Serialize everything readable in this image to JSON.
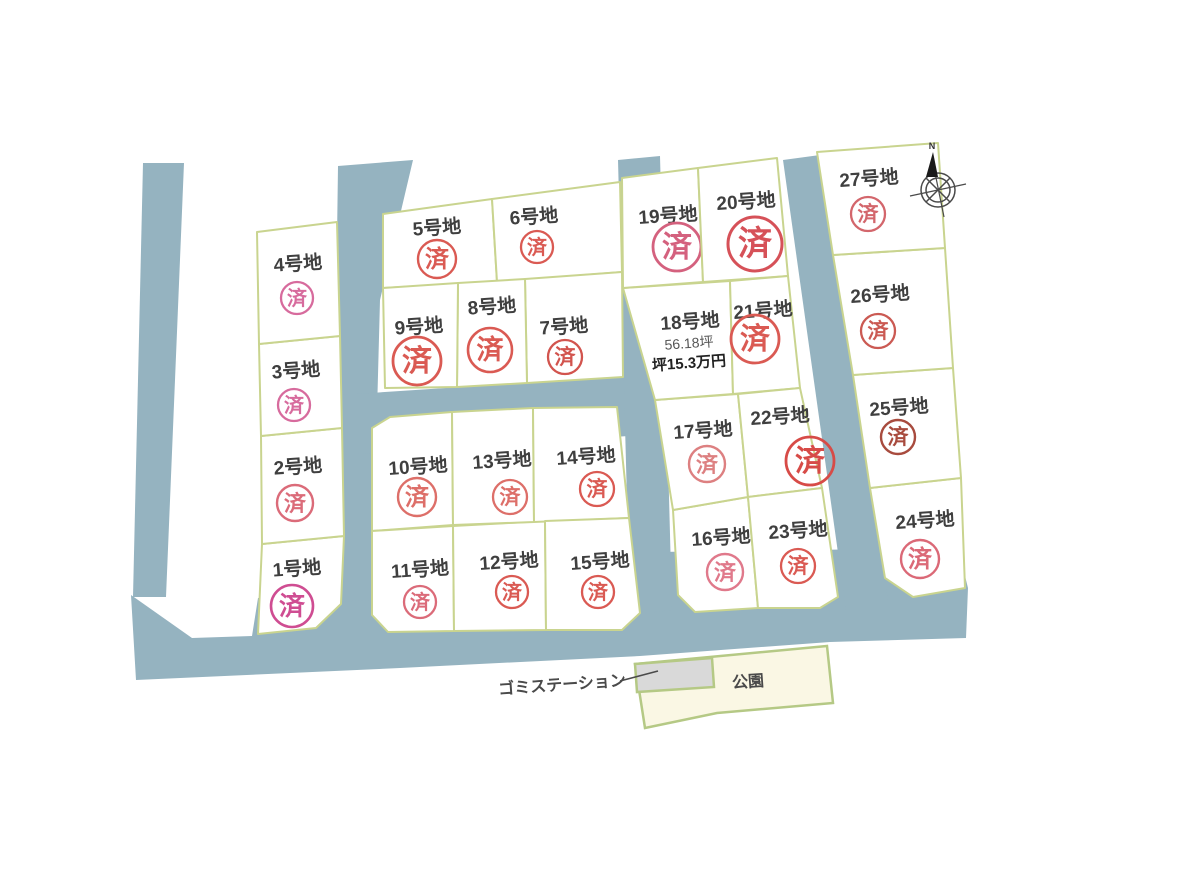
{
  "legend": {
    "sold_label": "済"
  },
  "lots": [
    {
      "id": 1,
      "label": "1号地",
      "sold": true,
      "mark_color": "#cf4d92"
    },
    {
      "id": 2,
      "label": "2号地",
      "sold": true,
      "mark_color": "#db6b79"
    },
    {
      "id": 3,
      "label": "3号地",
      "sold": true,
      "mark_color": "#d76b9d"
    },
    {
      "id": 4,
      "label": "4号地",
      "sold": true,
      "mark_color": "#d76b9d"
    },
    {
      "id": 5,
      "label": "5号地",
      "sold": true,
      "mark_color": "#da5a53"
    },
    {
      "id": 6,
      "label": "6号地",
      "sold": true,
      "mark_color": "#da5a53"
    },
    {
      "id": 7,
      "label": "7号地",
      "sold": true,
      "mark_color": "#d2544e"
    },
    {
      "id": 8,
      "label": "8号地",
      "sold": true,
      "mark_color": "#da5a53"
    },
    {
      "id": 9,
      "label": "9号地",
      "sold": true,
      "mark_color": "#da5a53"
    },
    {
      "id": 10,
      "label": "10号地",
      "sold": true,
      "mark_color": "#dd6f69"
    },
    {
      "id": 11,
      "label": "11号地",
      "sold": true,
      "mark_color": "#db6b79"
    },
    {
      "id": 12,
      "label": "12号地",
      "sold": true,
      "mark_color": "#da5a53"
    },
    {
      "id": 13,
      "label": "13号地",
      "sold": true,
      "mark_color": "#dd6f69"
    },
    {
      "id": 14,
      "label": "14号地",
      "sold": true,
      "mark_color": "#da5a53"
    },
    {
      "id": 15,
      "label": "15号地",
      "sold": true,
      "mark_color": "#da5a53"
    },
    {
      "id": 16,
      "label": "16号地",
      "sold": true,
      "mark_color": "#e0798b"
    },
    {
      "id": 17,
      "label": "17号地",
      "sold": true,
      "mark_color": "#dd8081"
    },
    {
      "id": 18,
      "label": "18号地",
      "sold": false,
      "area": "56.18坪",
      "unit_price": "坪15.3万円"
    },
    {
      "id": 19,
      "label": "19号地",
      "sold": true,
      "mark_color": "#d4617e"
    },
    {
      "id": 20,
      "label": "20号地",
      "sold": true,
      "mark_color": "#d65158"
    },
    {
      "id": 21,
      "label": "21号地",
      "sold": true,
      "mark_color": "#da5a53"
    },
    {
      "id": 22,
      "label": "22号地",
      "sold": true,
      "mark_color": "#d74b47"
    },
    {
      "id": 23,
      "label": "23号地",
      "sold": true,
      "mark_color": "#da5a53"
    },
    {
      "id": 24,
      "label": "24号地",
      "sold": true,
      "mark_color": "#db6977"
    },
    {
      "id": 25,
      "label": "25号地",
      "sold": true,
      "mark_color": "#a84b3e"
    },
    {
      "id": 26,
      "label": "26号地",
      "sold": true,
      "mark_color": "#cb5a53"
    },
    {
      "id": 27,
      "label": "27号地",
      "sold": true,
      "mark_color": "#d3666c"
    }
  ],
  "landmarks": {
    "garbage_station": "ゴミステーション",
    "park": "公園"
  },
  "compass": {
    "north_label": "N"
  },
  "colors": {
    "road": "#95b3c0",
    "lot_fill": "#ffffff",
    "lot_border": "#c9d48f",
    "park_fill": "#faf7e4",
    "park_border": "#b5c985",
    "station_fill": "#d9d9d9"
  }
}
